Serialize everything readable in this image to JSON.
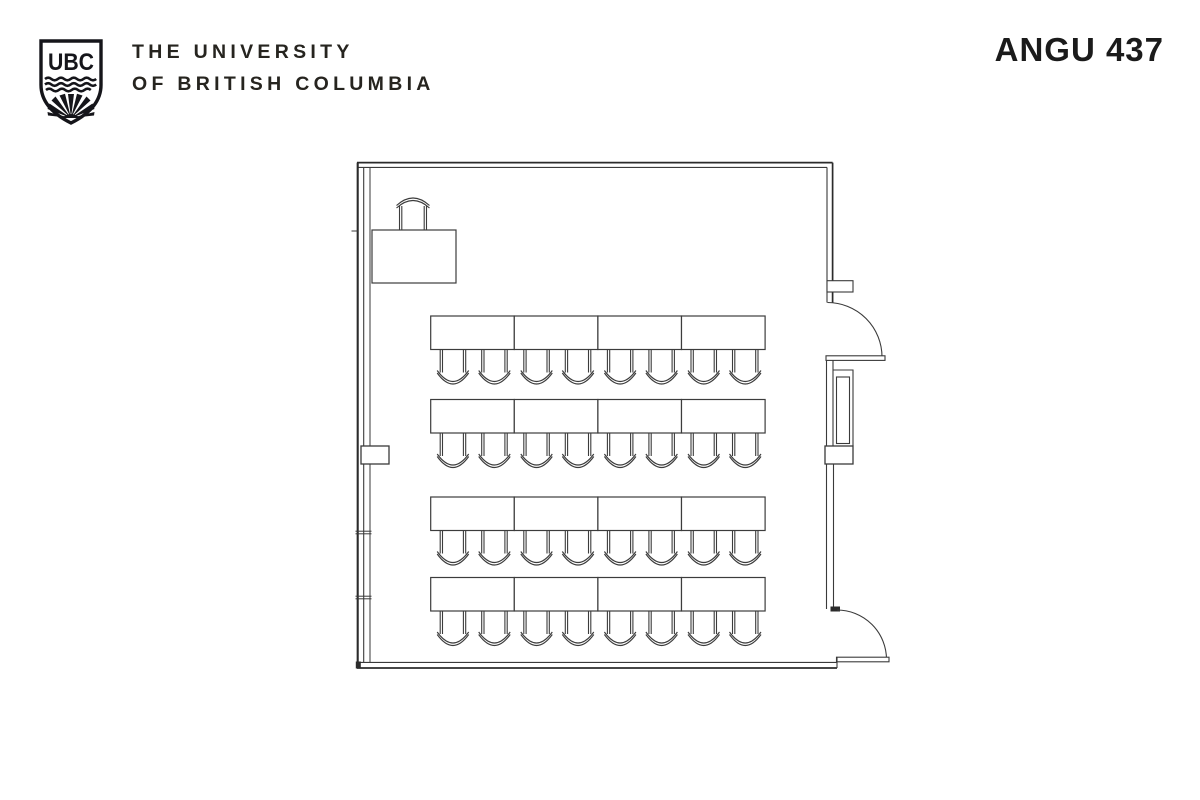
{
  "header": {
    "logo": {
      "letters": "UBC"
    },
    "university_name_line1": "THE UNIVERSITY",
    "university_name_line2": "OF BRITISH COLUMBIA",
    "room_code": "ANGU 437"
  },
  "colors": {
    "background": "#ffffff",
    "logo_ink": "#15151a",
    "wordmark_ink": "#26241f",
    "room_code_ink": "#1b1b1b",
    "plan_line": "#3a3a3a",
    "furniture_line": "#3c3c3c"
  },
  "floor_plan": {
    "type": "classroom-seating-plan",
    "table_count": 16,
    "student_seat_count": 32,
    "presenter_seat_count": 1,
    "rows": [
      {
        "name": "table-row-1",
        "y": 316,
        "tables": 4
      },
      {
        "name": "table-row-2",
        "y": 399.5,
        "tables": 4
      },
      {
        "name": "table-row-3",
        "y": 497,
        "tables": 4
      },
      {
        "name": "table-row-4",
        "y": 577.5,
        "tables": 4
      }
    ],
    "row_x": 430.7,
    "table": {
      "w": 83.6,
      "h": 33.5
    },
    "chairs_per_table": 2,
    "chair": {
      "w": 25.5,
      "seat_h": 23,
      "offsets": [
        9.5,
        51
      ]
    },
    "podium": {
      "desk": {
        "x": 372,
        "y": 230,
        "w": 84,
        "h": 53
      },
      "chair": {
        "x": 399.5,
        "y": 206,
        "w": 27,
        "seat_h": 24
      }
    }
  }
}
